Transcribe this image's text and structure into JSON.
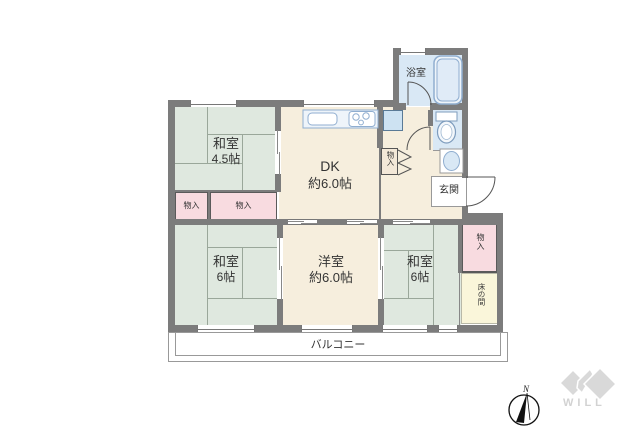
{
  "floor_plan": {
    "rooms": {
      "washitsu_45": {
        "label": "和室",
        "size": "4.5帖"
      },
      "dk": {
        "label": "DK",
        "size": "約6.0帖"
      },
      "bathroom": {
        "label": "浴室"
      },
      "genkan": {
        "label": "玄関"
      },
      "washitsu_6_left": {
        "label": "和室",
        "size": "6帖"
      },
      "youshitsu": {
        "label": "洋室",
        "size": "約6.0帖"
      },
      "washitsu_6_right": {
        "label": "和室",
        "size": "6帖"
      },
      "tokonoma": {
        "label": "床の間"
      },
      "balcony": {
        "label": "バルコニー"
      }
    },
    "closets": {
      "left_small": {
        "label": "物入"
      },
      "left_large": {
        "label": "物入"
      },
      "hall": {
        "label": "物入"
      },
      "right": {
        "label": "物入"
      }
    },
    "compass": {
      "north": "N"
    },
    "branding": {
      "logo_text": "WILL"
    },
    "colors": {
      "wall": "#7c7c7c",
      "tatami_green": "#dfe8df",
      "flooring_cream": "#f6eedd",
      "closet_pink": "#f8dbe0",
      "wet_area_blue": "#d9e8f5",
      "tokonoma_cream": "#faf6da",
      "fixture_stroke": "#90aed0",
      "logo_gray": "#d9d9d9"
    }
  }
}
